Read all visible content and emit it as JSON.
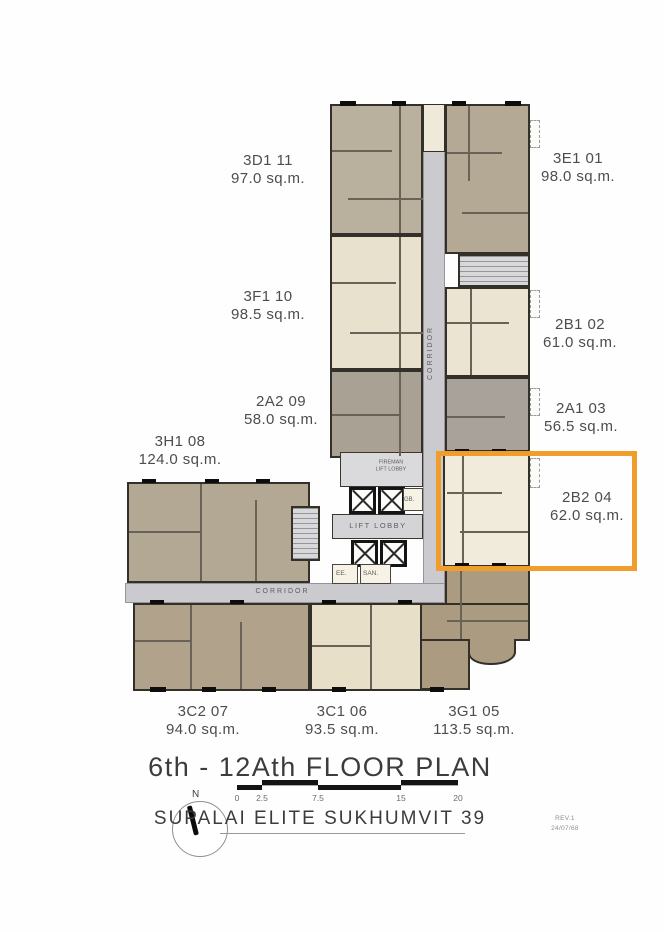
{
  "plan": {
    "units": [
      {
        "code": "3D1 11",
        "area": "97.0 sq.m."
      },
      {
        "code": "3E1 01",
        "area": "98.0 sq.m."
      },
      {
        "code": "3F1 10",
        "area": "98.5 sq.m."
      },
      {
        "code": "2B1 02",
        "area": "61.0 sq.m."
      },
      {
        "code": "2A2 09",
        "area": "58.0 sq.m."
      },
      {
        "code": "2A1 03",
        "area": "56.5 sq.m."
      },
      {
        "code": "3H1 08",
        "area": "124.0 sq.m."
      },
      {
        "code": "2B2 04",
        "area": "62.0 sq.m."
      },
      {
        "code": "3C2 07",
        "area": "94.0 sq.m."
      },
      {
        "code": "3C1 06",
        "area": "93.5 sq.m."
      },
      {
        "code": "3G1 05",
        "area": "113.5 sq.m."
      }
    ],
    "labels": {
      "corridor_vertical": "CORRIDOR",
      "corridor_horizontal": "CORRIDOR",
      "fireman_line1": "FIREMAN",
      "fireman_line2": "LIFT LOBBY",
      "lift_lobby": "LIFT LOBBY",
      "gb": "GB.",
      "ee": "EE.",
      "san": "SAN."
    },
    "highlight": {
      "unit_code": "2B2 04",
      "color": "#F09D2C"
    }
  },
  "footer": {
    "title": "6th - 12Ath FLOOR PLAN",
    "project": "SUPALAI ELITE SUKHUMVIT 39",
    "compass": {
      "north": "N"
    },
    "scale": {
      "ticks": [
        "0",
        "2.5",
        "7.5",
        "15",
        "20"
      ]
    },
    "revision": {
      "line1": "REV.1",
      "line2": "24/07/68"
    }
  }
}
